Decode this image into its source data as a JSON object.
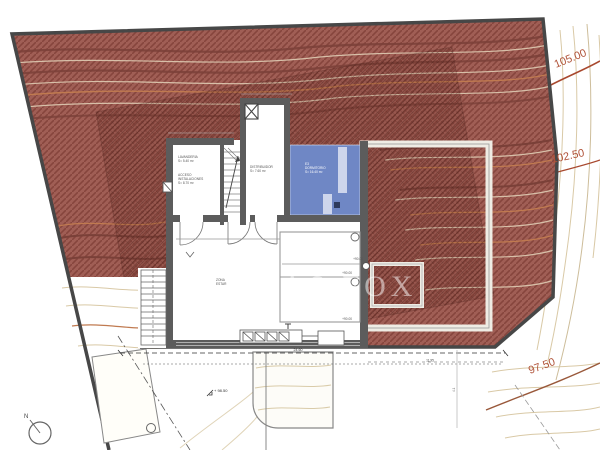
{
  "colors": {
    "plot_red": "#a05e55",
    "hatch_red": "#86453d",
    "pool_blue": "#6f87c5",
    "contour_label_orange": "#b05238",
    "wall_gray": "#5c5c5c"
  },
  "watermark_text": "LUCAS FOX",
  "north_label": "N",
  "elevations": {
    "upper": "105.00",
    "mid": "102.50",
    "lower": "97.50"
  },
  "spot_level": "+ 98.50",
  "levels": {
    "terrace": "+90.00",
    "pool_top": "+90.00",
    "pool_bottom": "+90.00"
  },
  "dims": {
    "total_width": "24.60",
    "inner_width": "11.95",
    "terrace_depth": "4.1"
  },
  "rooms": {
    "utility": {
      "line1": "LAVANDERIA",
      "line2": "S= 5.40 m²"
    },
    "entry": {
      "line1": "ACCESO",
      "line2": "INSTALACIONES",
      "line3": "S= 8.70 m²"
    },
    "corridor": {
      "line1": "DISTRIBUIDOR",
      "line2": "S= 7.60 m²"
    },
    "bedroom": {
      "line1": "E3",
      "line2": "DORMITORIO",
      "line3": "S= 16.40 m²"
    },
    "living": {
      "line1": "ZONA",
      "line2": "ESTAR"
    }
  }
}
